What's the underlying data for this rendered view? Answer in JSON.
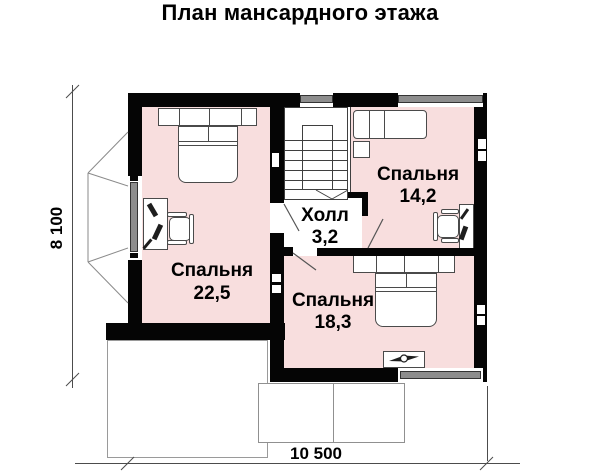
{
  "title": "План мансардного этажа",
  "rooms": [
    {
      "name": "Спальня",
      "area": "22,5"
    },
    {
      "name": "Спальня",
      "area": "14,2"
    },
    {
      "name": "Спальня",
      "area": "18,3"
    },
    {
      "name": "Холл",
      "area": "3,2"
    }
  ],
  "dimensions": {
    "overall_width_mm": "10 500",
    "overall_height_mm": "8 100"
  },
  "colors": {
    "wall": "#050505",
    "room": "#f8dede",
    "win": "#8d8d8d",
    "line": "#7d7d7d",
    "furn": "#4a4a4a"
  }
}
